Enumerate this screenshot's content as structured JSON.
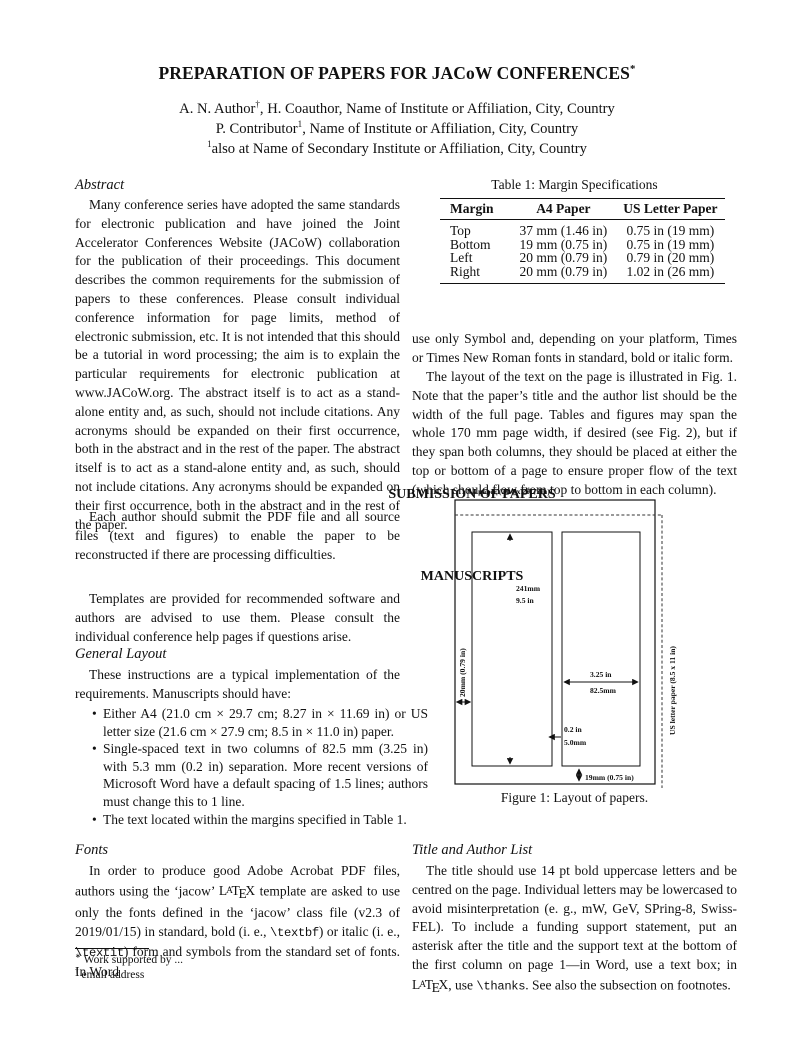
{
  "header": {
    "title": "PREPARATION OF PAPERS FOR JACoW CONFERENCES{sup}*{/sup}",
    "authors": [
      "A. N. Author{sup}†{/sup}, H. Coauthor, Name of Institute or Affiliation, City, Country",
      "P. Contributor{sup}1{/sup}, Name of Institute or Affiliation, City, Country",
      "{sup}1{/sup}also at Name of Secondary Institute or Affiliation, City, Country"
    ]
  },
  "left_column": {
    "abstract": {
      "heading": "Abstract",
      "text": "Many conference series have adopted the same standards for electronic publication and have joined the Joint Accelerator Conferences Website (JACoW) collaboration for the publication of their proceedings. This document describes the common requirements for the submission of papers to these conferences. Please consult individual conference information for page limits, method of electronic submission, etc. It is not intended that this should be a tutorial in word processing; the aim is to explain the particular requirements for electronic publication at www.JACoW.org. The abstract itself is to act as a stand-alone entity and, as such, should not include citations. Any acronyms should be expanded on their first occurrence, both in the abstract and in the rest of the paper. The abstract itself is to act as a stand-alone entity and, as such, should not include citations. Any acronyms should be expanded on their first occurrence, both in the abstract and in the rest of the paper."
    },
    "submission": {
      "heading": "SUBMISSION OF PAPERS",
      "text": "Each author should submit the PDF file and all source files (text and figures) to enable the paper to be reconstructed if there are processing difficulties."
    },
    "manuscripts": {
      "heading": "MANUSCRIPTS",
      "text": "Templates are provided for recommended software and authors are advised to use them. Please consult the individual conference help pages if questions arise."
    },
    "general_layout": {
      "heading": "General Layout",
      "intro": "These instructions are a typical implementation of the requirements. Manuscripts should have:",
      "bullets": [
        "Either A4 (21.0 cm × 29.7 cm; 8.27 in × 11.69 in) or US letter size (21.6 cm × 27.9 cm; 8.5 in × 11.0 in) paper.",
        "Single-spaced text in two columns of 82.5 mm (3.25 in) with 5.3 mm (0.2 in) separation. More recent versions of Microsoft Word have a default spacing of 1.5 lines; authors must change this to 1 line.",
        "The text located within the margins specified in Table 1."
      ]
    },
    "fonts": {
      "heading": "Fonts",
      "text": "In order to produce good Adobe Acrobat PDF files, authors using the ‘jacow’ {latex} template are asked to use only the fonts defined in the ‘jacow’ class file (v2.3 of 2019/01/15) in standard, bold (i. e., {mono}\\textbf{/mono}) or italic (i. e., {mono}\\textit{/mono}) form and symbols from the standard set of fonts. In Word"
    },
    "footnotes": [
      "{sup}∗{/sup} Work supported by ...",
      "{sup}†{/sup} email address"
    ]
  },
  "right_column": {
    "table": {
      "caption": "Table 1: Margin Specifications",
      "headers": [
        "Margin",
        "A4 Paper",
        "US Letter Paper"
      ],
      "rows": [
        [
          "Top",
          "37 mm (1.46 in)",
          "0.75 in (19 mm)"
        ],
        [
          "Bottom",
          "19 mm (0.75 in)",
          "0.75 in (19 mm)"
        ],
        [
          "Left",
          "20 mm (0.79 in)",
          "0.79 in (20 mm)"
        ],
        [
          "Right",
          "20 mm (0.79 in)",
          "1.02 in (26 mm)"
        ]
      ]
    },
    "body": {
      "para1": "use only Symbol and, depending on your platform, Times or Times New Roman fonts in standard, bold or italic form.",
      "para2": "The layout of the text on the page is illustrated in Fig. 1. Note that the paper’s title and the author list should be the width of the full page. Tables and figures may span the whole 170 mm page width, if desired (see Fig. 2), but if they span both columns, they should be placed at either the top or bottom of a page to ensure proper flow of the text (which should flow from top to bottom in each column)."
    },
    "figure": {
      "labels": {
        "a4": "A4 paper (21.0 x 29.7 cm)",
        "col_height_mm": "241mm",
        "col_height_in": "9.5 in",
        "left_margin": "20mm (0.79 in)",
        "col_width_in": "3.25 in",
        "col_width_mm": "82.5mm",
        "gap_in": "0.2 in",
        "gap_mm": "5.0mm",
        "bottom_margin": "19mm (0.75 in)",
        "us_letter": "US letter paper (8.5 x 11 in)"
      },
      "caption": "Figure 1: Layout of papers."
    },
    "title_author_list": {
      "heading": "Title and Author List",
      "text": "The title should use 14 pt bold uppercase letters and be centred on the page. Individual letters may be lowercased to avoid misinterpretation (e. g., mW, GeV, SPring-8, Swiss-FEL). To include a funding support statement, put an asterisk after the title and the support text at the bottom of the first column on page 1—in Word, use a text box; in {latex}, use {mono}\\thanks{/mono}. See also the subsection on footnotes."
    }
  }
}
